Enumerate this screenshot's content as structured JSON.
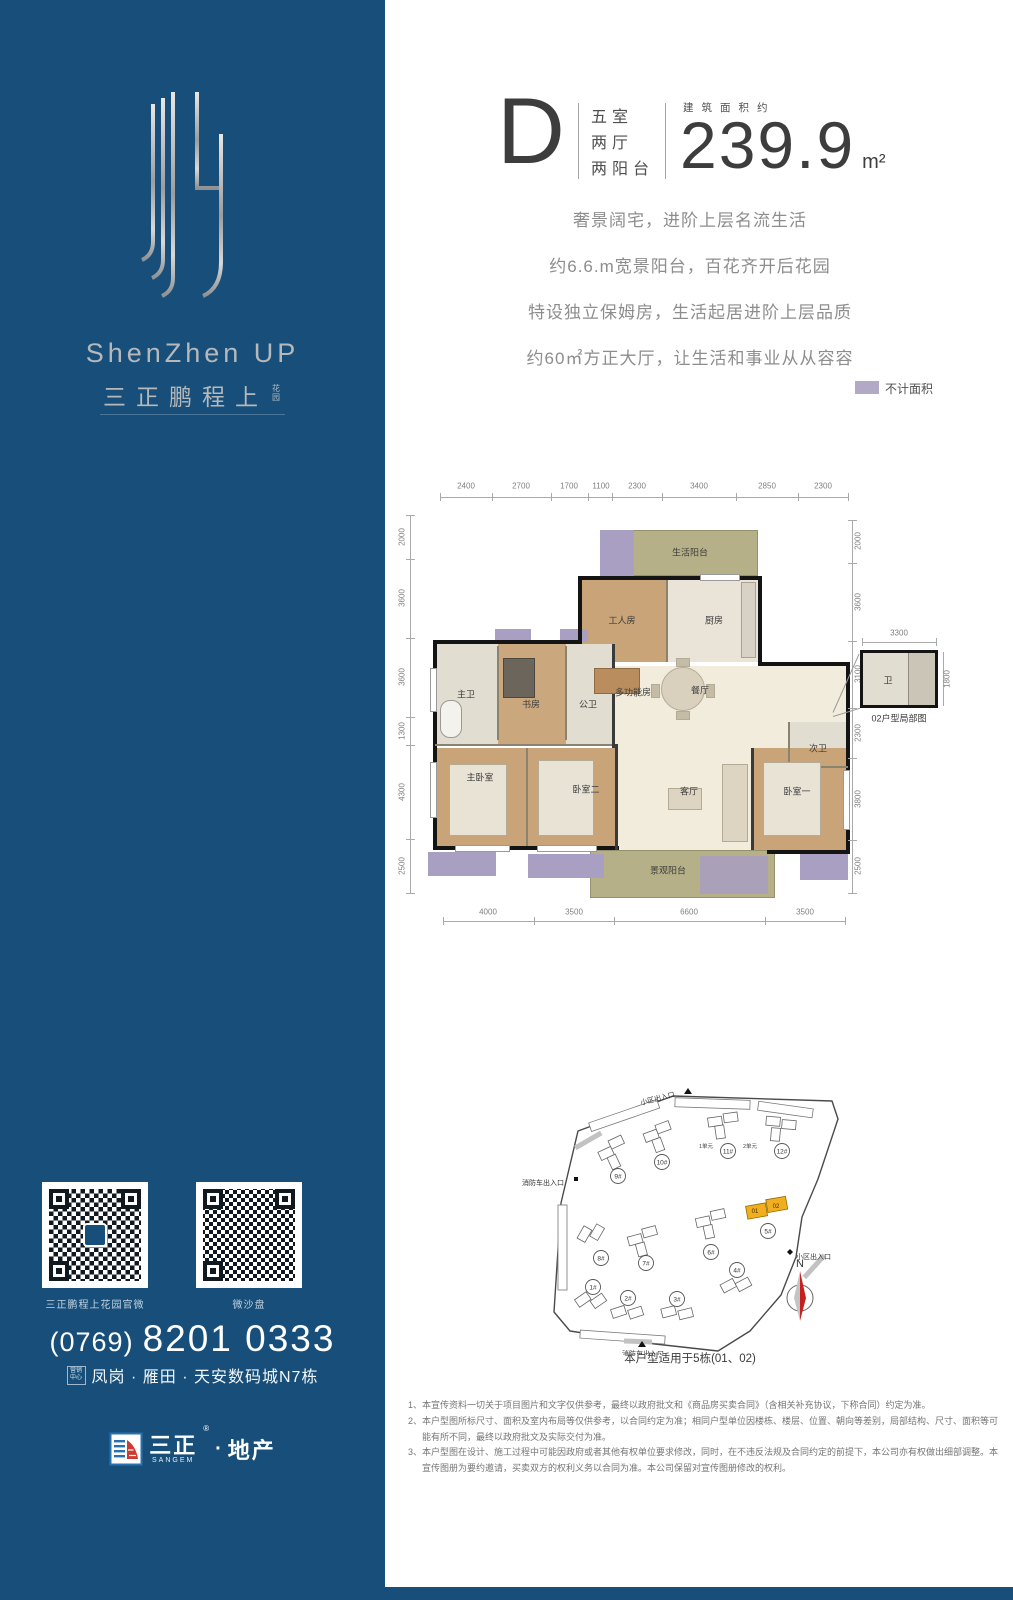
{
  "sidebar": {
    "brand_en": "ShenZhen UP",
    "brand_cn": "三正鹏程上",
    "brand_small": "花园",
    "qr_codes": [
      {
        "label": "三正鹏程上花园官微"
      },
      {
        "label": "微沙盘"
      }
    ],
    "phone": {
      "area": "(0769)",
      "number": "8201 0333"
    },
    "address": {
      "badge_top": "营销",
      "badge_bottom": "中心",
      "text": "凤岗 · 雁田 · 天安数码城N7栋"
    },
    "company": {
      "name": "三正",
      "mark": "®",
      "sep": "·",
      "type": "地产",
      "en": "SANGEM"
    }
  },
  "header": {
    "unit_type": "D",
    "rooms_lines": [
      "五室",
      "两厅",
      "两阳台"
    ],
    "area_label": "建筑面积约",
    "area_value": "239.9",
    "area_unit": "m²"
  },
  "selling_points": [
    "奢景阔宅，进阶上层名流生活",
    "约6.6.m宽景阳台，百花齐开后花园",
    "特设独立保姆房，生活起居进阶上层品质",
    "约60㎡方正大厅，让生活和事业从从容容"
  ],
  "legend": {
    "label": "不计面积",
    "swatch_color": "#b1a9c6"
  },
  "floorplan": {
    "dims_top": [
      "2400",
      "2700",
      "1700",
      "1100",
      "2300",
      "3400",
      "2850",
      "2300"
    ],
    "dims_bottom": [
      "4000",
      "3500",
      "6600",
      "3500"
    ],
    "dims_left": [
      "2000",
      "3600",
      "3600",
      "1300",
      "4300",
      "2500"
    ],
    "dims_right": [
      "2000",
      "3600",
      "3100",
      "2300",
      "3800",
      "2500"
    ],
    "rooms": {
      "life_balcony": "生活阳台",
      "maid_room": "工人房",
      "kitchen": "厨房",
      "master_bath": "主卫",
      "study": "书房",
      "public_bath": "公卫",
      "multi_room": "多功能房",
      "dining": "餐厅",
      "second_bath": "次卫",
      "master_bedroom": "主卧室",
      "bedroom_two": "卧室二",
      "living_room": "客厅",
      "bedroom_one": "卧室一",
      "view_balcony": "景观阳台"
    },
    "inset": {
      "dim_top": "3300",
      "dim_side": "1800",
      "room": "卫",
      "caption": "02户型局部图"
    }
  },
  "siteplan": {
    "buildings": [
      "1#",
      "2#",
      "3#",
      "4#",
      "5#",
      "6#",
      "7#",
      "8#",
      "9#",
      "10#",
      "11#",
      "12#"
    ],
    "units": [
      "1单元",
      "2单元"
    ],
    "highlight_units": [
      "01",
      "02"
    ],
    "entrances": {
      "top": "小区出入口",
      "left": "消防车出入口",
      "right": "小区出入口",
      "bottom": "消防车出入口"
    },
    "north": "N",
    "caption": "本户型适用于5栋(01、02)"
  },
  "disclaimer": [
    "1、本宣传资料一切关于项目图片和文字仅供参考，最终以政府批文和《商品房买卖合同》（含相关补充协议，下称合同）约定为准。",
    "2、本户型图所标尺寸、面积及室内布局等仅供参考，以合同约定为准；相同户型单位因楼栋、楼层、位置、朝向等差别，局部结构、尺寸、面积等可能有所不同，最终以政府批文及实际交付为准。",
    "3、本户型图在设计、施工过程中可能因政府或者其他有权单位要求修改，同时，在不违反法规及合同约定的前提下，本公司亦有权做出细部调整。本宣传图册为要约邀请，买卖双方的权利义务以合同为准。本公司保留对宣传图册修改的权利。"
  ]
}
